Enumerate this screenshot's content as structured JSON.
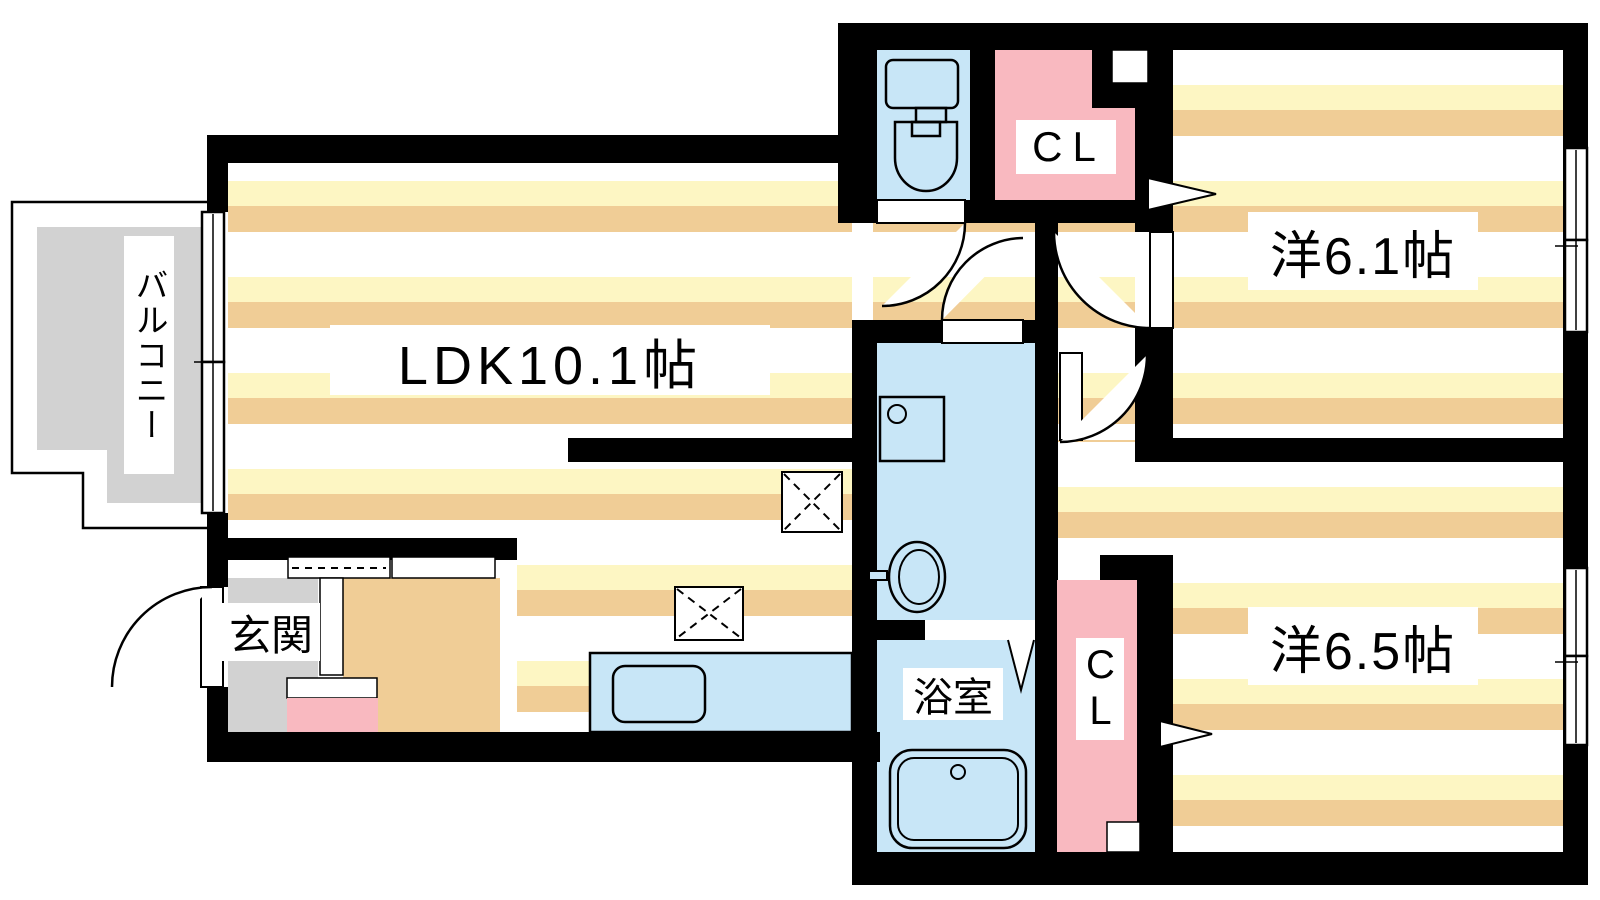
{
  "rooms": {
    "ldk": {
      "label": "LDK10.1帖"
    },
    "western1": {
      "label": "洋6.1帖"
    },
    "western2": {
      "label": "洋6.5帖"
    },
    "bath": {
      "label": "浴室"
    },
    "entrance": {
      "label": "玄関"
    },
    "balcony": {
      "label": "バルコニー"
    },
    "closet_upper": {
      "label": "CL"
    },
    "closet_lower": {
      "label": "CL"
    }
  },
  "icons": [
    "toilet-icon",
    "washbasin-icon",
    "washing-machine-icon",
    "bathtub-icon",
    "kitchen-counter-icon",
    "kitchen-sink-icon",
    "overhead-cabinet-icon",
    "door-swing-icon",
    "sliding-window-icon",
    "folding-door-icon",
    "sliding-door-arrow-icon"
  ],
  "colors": {
    "stripe_cream": "#FDF6C3",
    "stripe_tan": "#F0CD96",
    "wet_area_blue": "#C8E6F7",
    "closet_pink": "#F9B9C0",
    "balcony_gray": "#D2D2D2",
    "wall_black": "#000000"
  }
}
